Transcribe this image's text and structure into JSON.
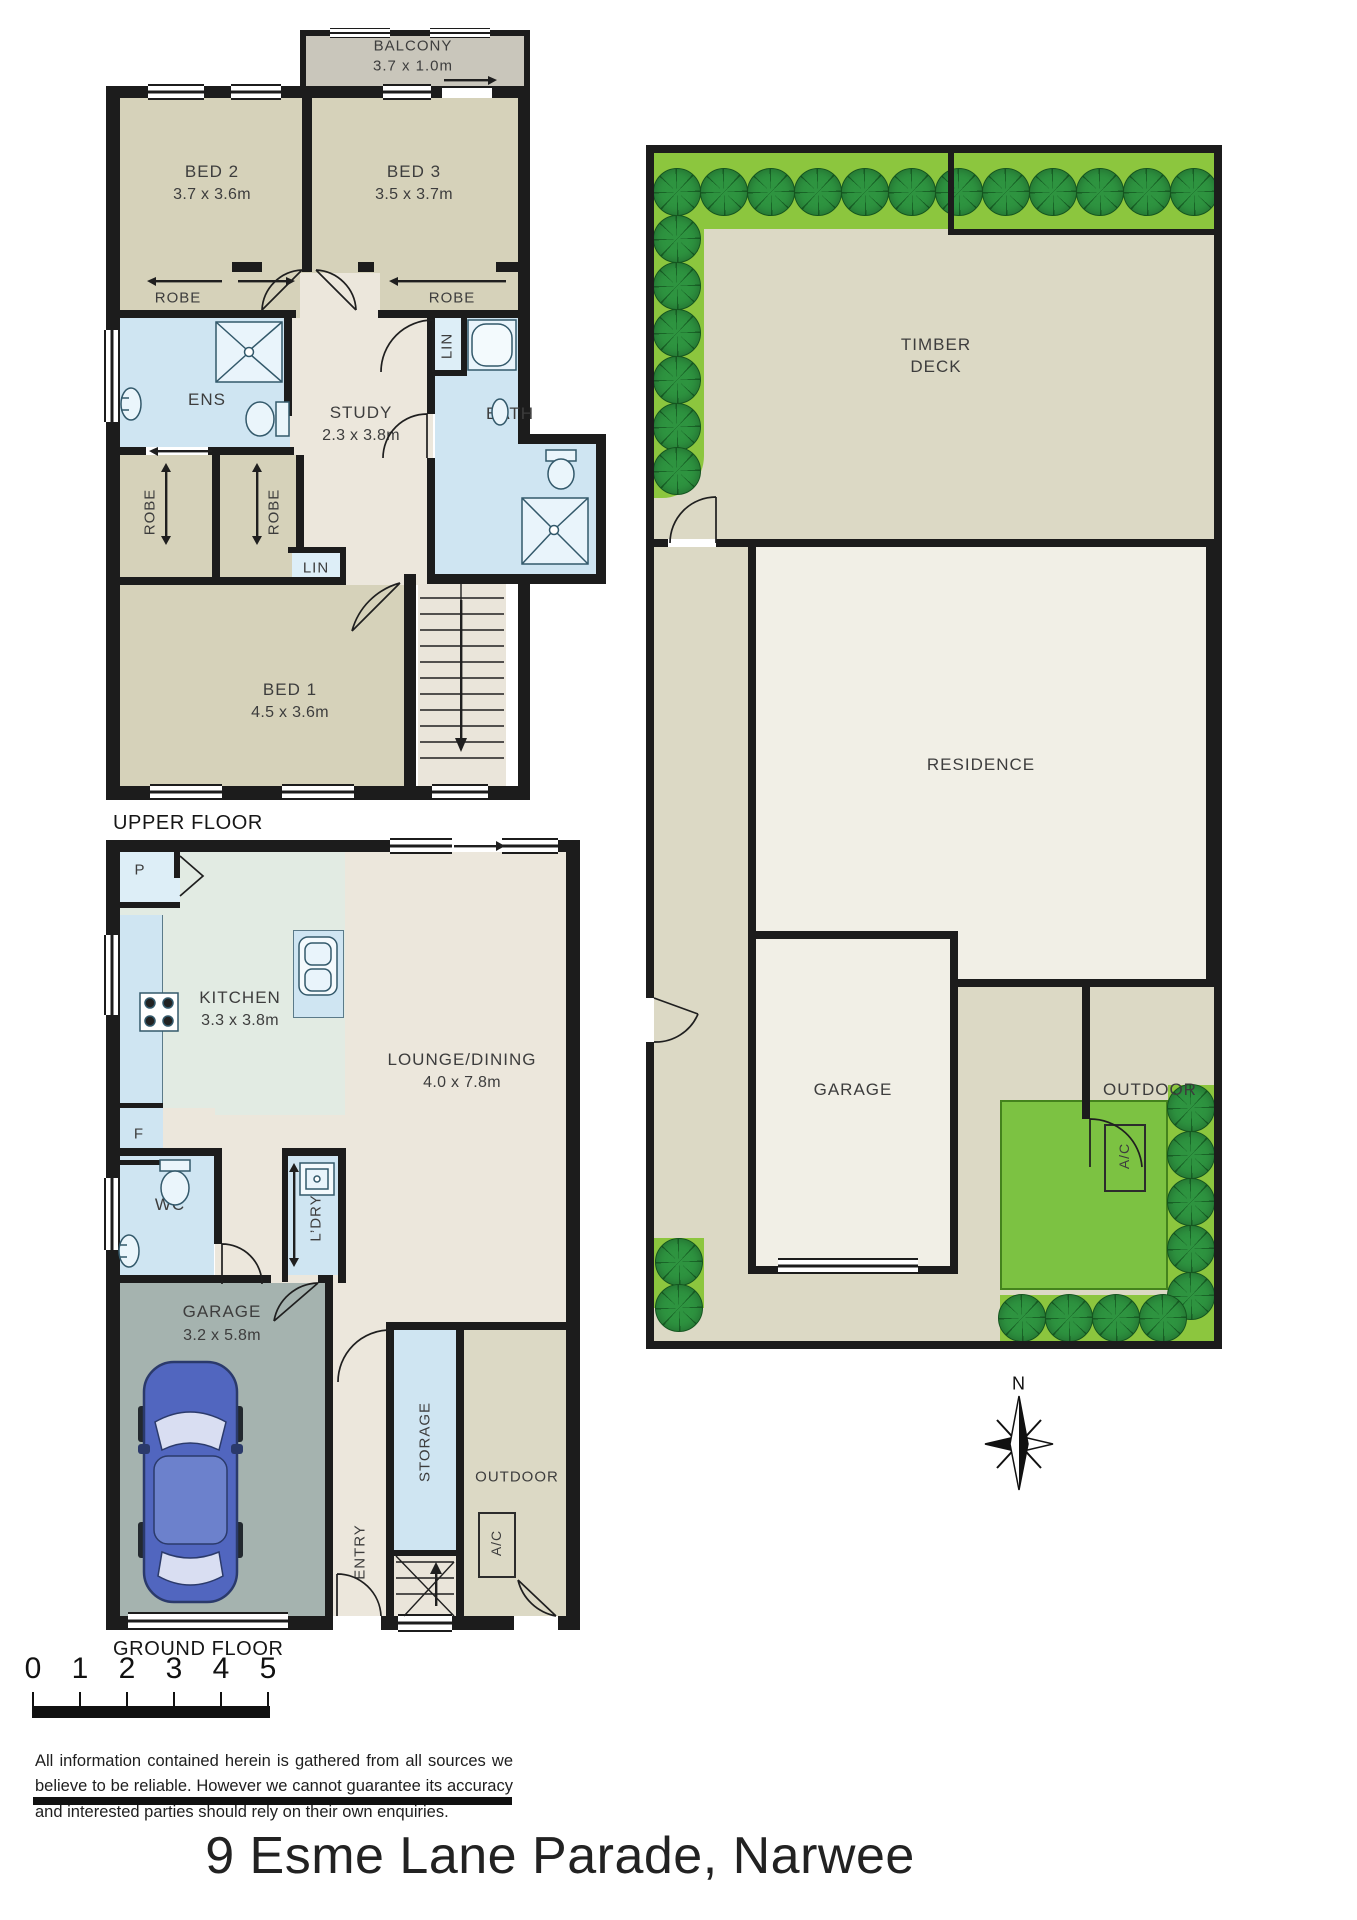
{
  "upper": {
    "floor_label": "UPPER FLOOR",
    "balcony": {
      "label": "BALCONY",
      "dims": "3.7 x 1.0m"
    },
    "bed2": {
      "label": "BED 2",
      "dims": "3.7 x 3.6m"
    },
    "bed3": {
      "label": "BED 3",
      "dims": "3.5 x 3.7m"
    },
    "robe_bed2": "ROBE",
    "robe_bed3": "ROBE",
    "ens": "ENS",
    "study": {
      "label": "STUDY",
      "dims": "2.3 x 3.8m"
    },
    "lin_upper": "LIN",
    "lin_hall": "LIN",
    "bath": "BATH",
    "robe_left": "ROBE",
    "robe_right": "ROBE",
    "bed1": {
      "label": "BED 1",
      "dims": "4.5 x 3.6m"
    }
  },
  "ground": {
    "floor_label": "GROUND FLOOR",
    "pantry": "P",
    "kitchen": {
      "label": "KITCHEN",
      "dims": "3.3 x 3.8m"
    },
    "fridge": "F",
    "lounge": {
      "label": "LOUNGE/DINING",
      "dims": "4.0 x 7.8m"
    },
    "wc": "WC",
    "laundry": "L’DRY",
    "garage": {
      "label": "GARAGE",
      "dims": "3.2 x 5.8m"
    },
    "entry": "ENTRY",
    "storage": "STORAGE",
    "outdoor": "OUTDOOR",
    "ac": "A/C"
  },
  "site": {
    "deck_line1": "TIMBER",
    "deck_line2": "DECK",
    "residence": "RESIDENCE",
    "garage": "GARAGE",
    "outdoor": "OUTDOOR",
    "ac": "A/C"
  },
  "scale_bar": {
    "ticks": [
      "0",
      "1",
      "2",
      "3",
      "4",
      "5"
    ]
  },
  "compass": {
    "north": "N"
  },
  "footer": {
    "disclaimer": "All information contained herein is gathered from all sources we believe to be reliable. However we cannot guarantee its accuracy and interested parties should rely on their own enquiries.",
    "address": "9 Esme Lane Parade, Narwee"
  },
  "colors": {
    "wall": "#1c1c1c",
    "bedroom": "#d6d2ba",
    "wet": "#cfe5f2",
    "wet_light": "#ddeef7",
    "kitchen": "#e2ebe3",
    "cream": "#ece7dc",
    "cream_dark": "#eae5da",
    "garage_floor": "#a5b3af",
    "balcony": "#c9c6bb",
    "site_ground": "#dcd9c5",
    "residence": "#f1efe6",
    "hedge": "#8cc63e",
    "tree": "#2e9440",
    "tree_dark": "#1a6628",
    "lawn": "#7cc242",
    "car": "#5166bf"
  }
}
